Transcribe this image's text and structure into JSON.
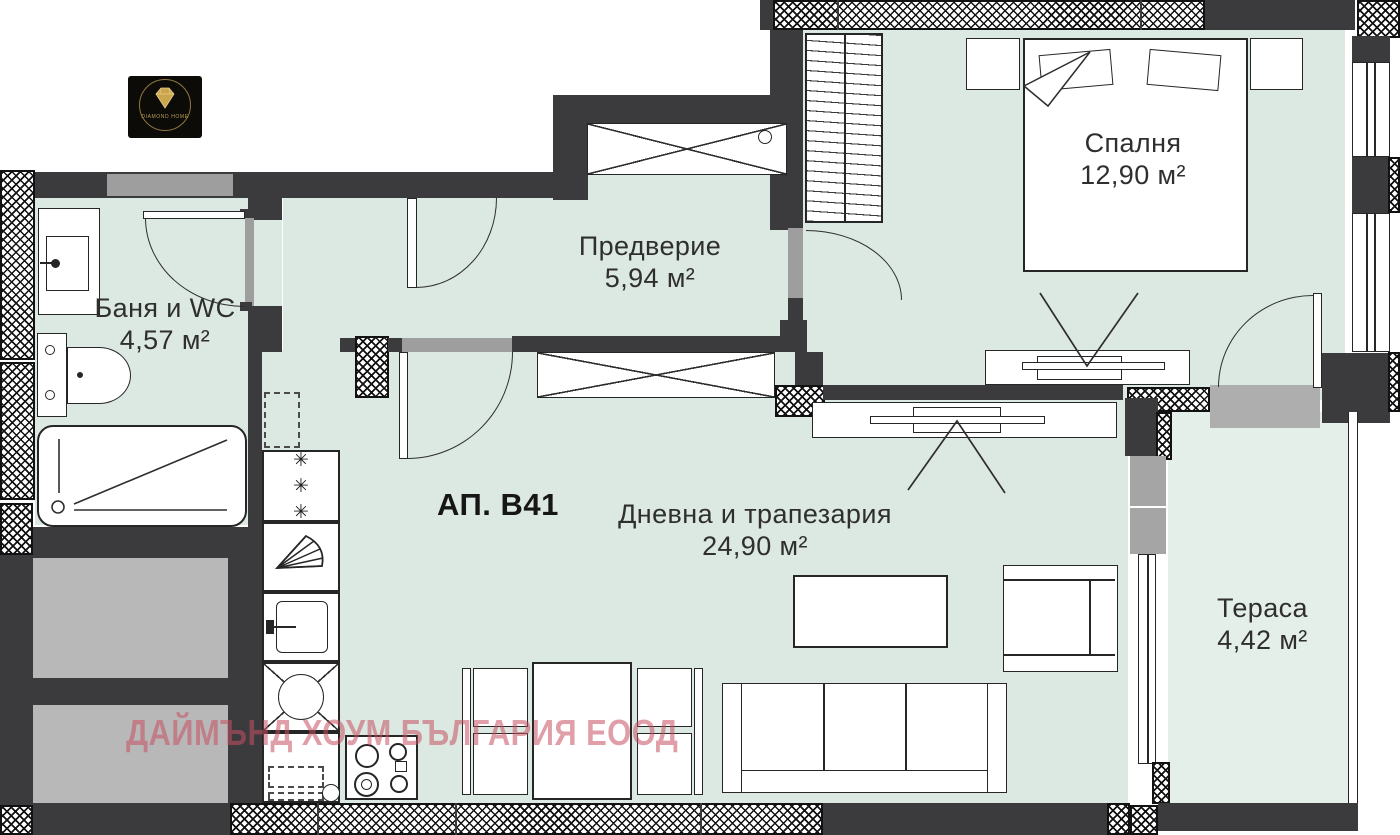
{
  "page": {
    "type": "apartment-floor-plan"
  },
  "logo": {
    "brand": "DIAMOND HOME"
  },
  "watermark": {
    "text": "ДАЙМЪНД ХОУМ БЪЛГАРИЯ ЕООД"
  },
  "apartment": {
    "label": "АП. В41"
  },
  "rooms": {
    "bathroom": {
      "name": "Баня и WC",
      "area": "4,57 м²"
    },
    "entry_hall": {
      "name": "Предверие",
      "area": "5,94 м²"
    },
    "bedroom": {
      "name": "Спалня",
      "area": "12,90 м²"
    },
    "living_dining": {
      "name": "Дневна и трапезария",
      "area": "24,90 м²"
    },
    "terrace": {
      "name": "Тераса",
      "area": "4,42 м²"
    }
  },
  "symbols": {
    "freezer_asterisk": "✳"
  },
  "colors": {
    "floor_mint": "#dce8e2",
    "terrace_mint": "#e5efe9",
    "wall_dark": "#3b3b3e",
    "watermark_red": "#c95060",
    "logo_gold": "#caa54e"
  }
}
